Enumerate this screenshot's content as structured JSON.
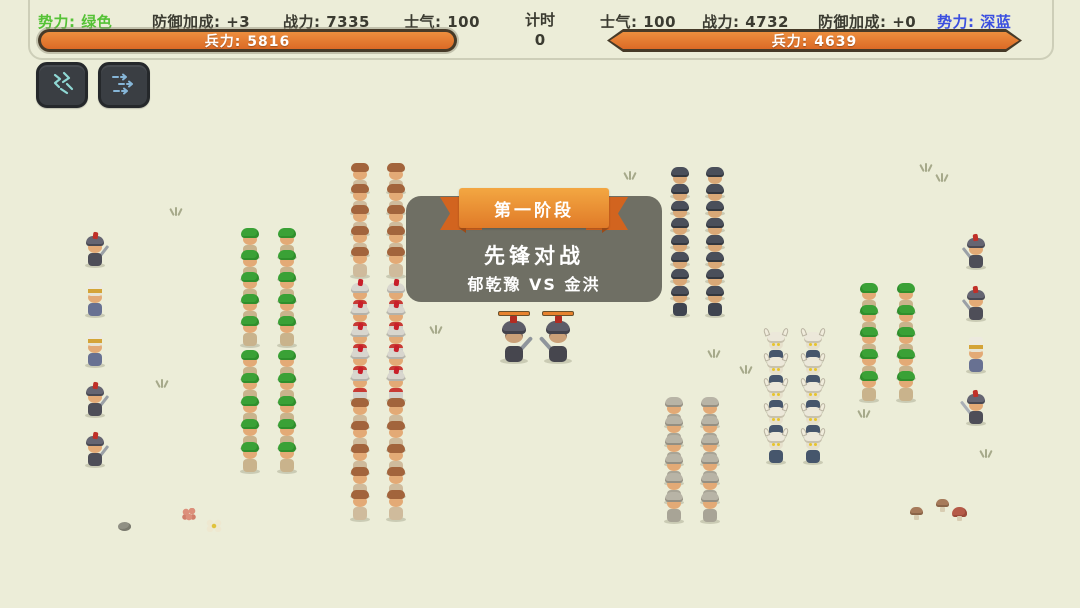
{
  "hud": {
    "left": {
      "faction": "势力: 绿色",
      "defense": "防御加成: +3",
      "power": "战力: 7335",
      "morale": "士气: 100",
      "troops": "兵力: 5816"
    },
    "timer": {
      "label": "计时",
      "value": "0"
    },
    "right": {
      "morale": "士气: 100",
      "power": "战力: 4732",
      "defense": "防御加成: +0",
      "faction": "势力: 深蓝",
      "troops": "兵力: 4639"
    },
    "skills": [
      {
        "icon": "cavalry-skill-icon"
      },
      {
        "icon": "charge-arrows-icon"
      }
    ],
    "colors": {
      "green_faction": "#55c236",
      "blue_faction": "#3b4fe0",
      "troop_bar_fill": "#e0742e",
      "troop_bar_border": "#463a28"
    }
  },
  "stage_panel": {
    "ribbon": "第一阶段",
    "title": "先锋对战",
    "matchup": "郁乾豫 VS 金洪",
    "panel_color": "#69695f",
    "ribbon_color": "#ec8e34"
  },
  "battlefield": {
    "background_color": "#ecedd8",
    "groups": [
      {
        "name": "green-flank-guards",
        "type": "knight",
        "x": 81,
        "y": 236,
        "cols": 1,
        "rows": 5,
        "dx": 37,
        "dy": 50,
        "mirror": false,
        "row_types": [
          "knight",
          "banner",
          "banner",
          "knight",
          "knight"
        ]
      },
      {
        "name": "green-archers-front",
        "type": "archer",
        "x": 236,
        "y": 228,
        "cols": 2,
        "rows": 5,
        "dx": 37,
        "dy": 22,
        "mirror": false
      },
      {
        "name": "green-archers-rear",
        "type": "archer",
        "x": 236,
        "y": 350,
        "cols": 2,
        "rows": 5,
        "dx": 37,
        "dy": 23,
        "mirror": false
      },
      {
        "name": "green-militia-top",
        "type": "peasant",
        "x": 346,
        "y": 163,
        "cols": 2,
        "rows": 5,
        "dx": 36,
        "dy": 21,
        "mirror": false
      },
      {
        "name": "green-red-knights",
        "type": "redknight",
        "x": 346,
        "y": 283,
        "cols": 2,
        "rows": 5,
        "dx": 36,
        "dy": 22,
        "mirror": false
      },
      {
        "name": "green-militia-bottom",
        "type": "peasant",
        "x": 346,
        "y": 398,
        "cols": 2,
        "rows": 5,
        "dx": 36,
        "dy": 23,
        "mirror": false
      },
      {
        "name": "blue-infantry",
        "type": "darksoldier",
        "x": 666,
        "y": 167,
        "cols": 2,
        "rows": 8,
        "dx": 35,
        "dy": 17,
        "mirror": true
      },
      {
        "name": "blue-silver-knights",
        "type": "silver",
        "x": 660,
        "y": 397,
        "cols": 2,
        "rows": 6,
        "dx": 36,
        "dy": 19,
        "mirror": true
      },
      {
        "name": "blue-berserkers",
        "type": "viking",
        "x": 762,
        "y": 333,
        "cols": 2,
        "rows": 5,
        "dx": 37,
        "dy": 25,
        "mirror": true
      },
      {
        "name": "blue-archers",
        "type": "archer",
        "x": 855,
        "y": 283,
        "cols": 2,
        "rows": 5,
        "dx": 37,
        "dy": 22,
        "mirror": true
      },
      {
        "name": "blue-flank-guards",
        "type": "knight",
        "x": 962,
        "y": 238,
        "cols": 1,
        "rows": 4,
        "dx": 37,
        "dy": 52,
        "mirror": true,
        "row_types": [
          "knight",
          "knight",
          "banner",
          "bigknight"
        ]
      }
    ],
    "duel": [
      {
        "name": "duel-champion-green",
        "type": "duel",
        "x": 496,
        "y": 320,
        "mirror": false
      },
      {
        "name": "duel-champion-blue",
        "type": "duel",
        "x": 540,
        "y": 320,
        "mirror": true
      }
    ],
    "decor": [
      {
        "kind": "grass",
        "x": 170,
        "y": 206
      },
      {
        "kind": "grass",
        "x": 156,
        "y": 378
      },
      {
        "kind": "grass",
        "x": 430,
        "y": 324
      },
      {
        "kind": "grass",
        "x": 624,
        "y": 170
      },
      {
        "kind": "grass",
        "x": 708,
        "y": 348
      },
      {
        "kind": "grass",
        "x": 740,
        "y": 364
      },
      {
        "kind": "grass",
        "x": 920,
        "y": 162
      },
      {
        "kind": "grass",
        "x": 936,
        "y": 172
      },
      {
        "kind": "grass",
        "x": 858,
        "y": 408
      },
      {
        "kind": "grass",
        "x": 980,
        "y": 448
      },
      {
        "kind": "stone",
        "x": 118,
        "y": 522
      },
      {
        "kind": "flower-pink",
        "x": 182,
        "y": 508
      },
      {
        "kind": "flower-white",
        "x": 206,
        "y": 519
      },
      {
        "kind": "mush mush-brown",
        "x": 910,
        "y": 507
      },
      {
        "kind": "mush mush-brown",
        "x": 936,
        "y": 499
      },
      {
        "kind": "mush mush-red",
        "x": 952,
        "y": 507
      }
    ]
  }
}
